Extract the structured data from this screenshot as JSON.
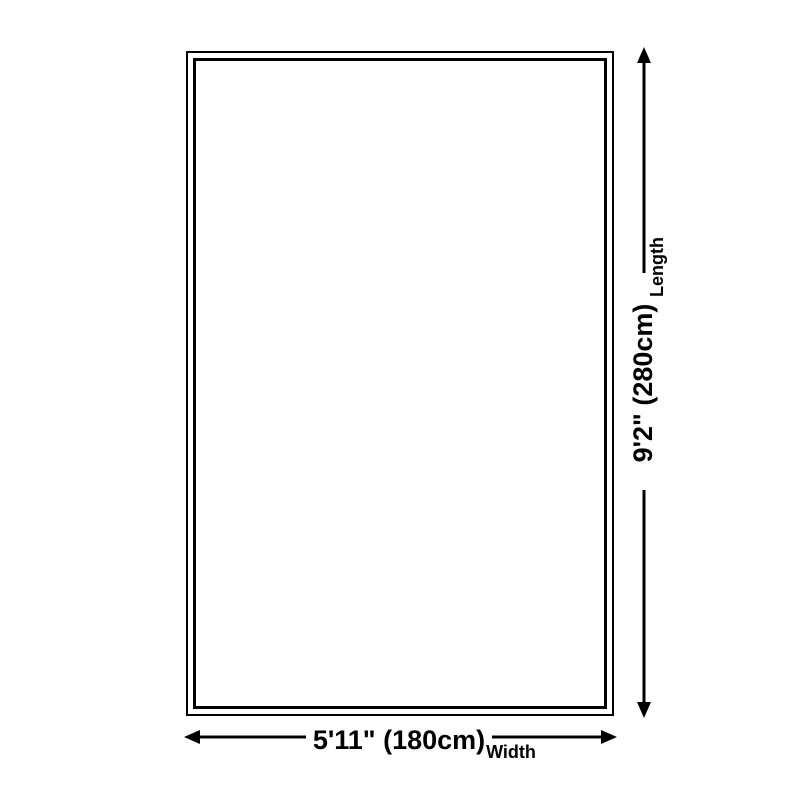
{
  "page": {
    "background_color": "#ffffff",
    "line_color": "#000000"
  },
  "diagram": {
    "shape": "rectangle-with-double-border",
    "length_dimension": {
      "value": "9'2\" (280cm)",
      "label": "Length"
    },
    "width_dimension": {
      "value": "5'11\" (180cm)",
      "label": "Width"
    }
  }
}
